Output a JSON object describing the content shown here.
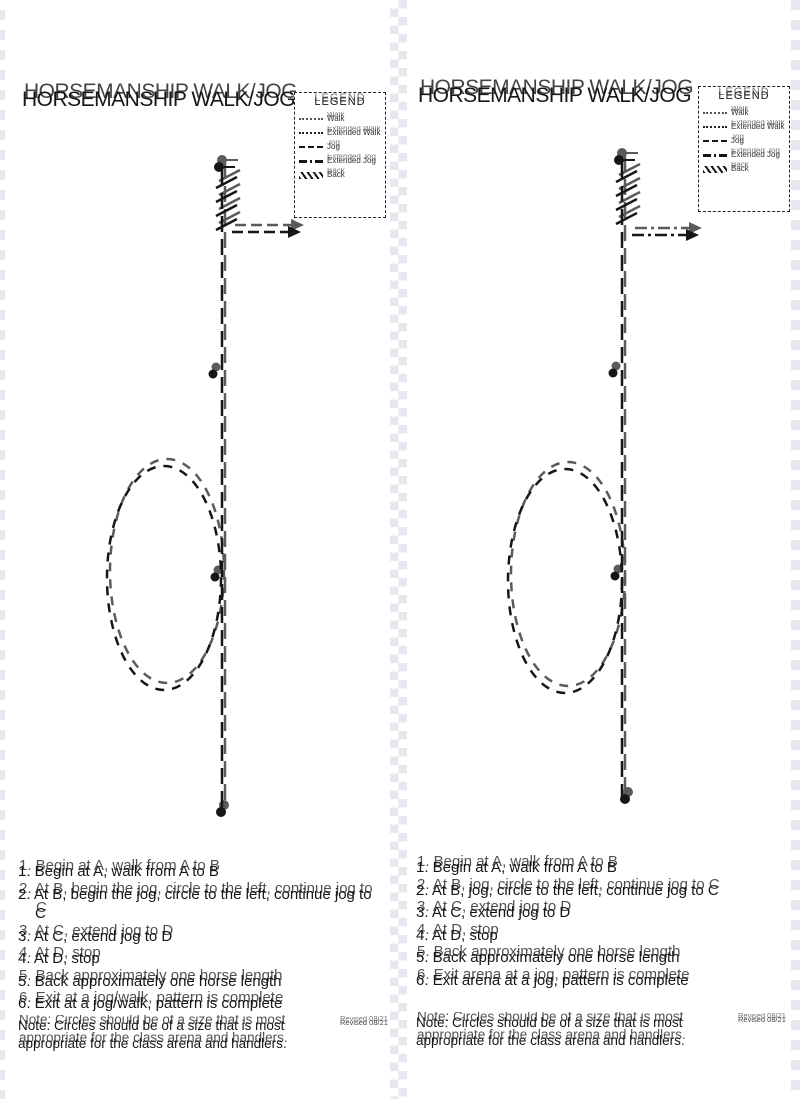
{
  "document": {
    "left_panel": {
      "title": "HORSEMANSHIP WALK/JOG",
      "legend": {
        "title": "LEGEND",
        "items": [
          {
            "label": "Walk",
            "symbol": "dotted-line"
          },
          {
            "label": "Extended Walk",
            "symbol": "dense-dotted-line"
          },
          {
            "label": "Jog",
            "symbol": "dashed-line"
          },
          {
            "label": "Extended Jog",
            "symbol": "dash-dot-line"
          },
          {
            "label": "Back",
            "symbol": "hatched-bar"
          }
        ]
      },
      "instructions": [
        "1. Begin at A, walk from A to B",
        "2. At B, begin the jog, circle to the left, continue jog to C",
        "3. At C, extend jog to D",
        "4. At D, stop",
        "5. Back approximately one horse length",
        "6. Exit at a jog/walk, pattern is complete"
      ],
      "note": "Note: Circles should be of a size that is most appropriate for the class arena and handlers.",
      "revised": "Revised 08/21"
    },
    "right_panel": {
      "title": "HORSEMANSHIP WALK/JOG",
      "legend": {
        "title": "LEGEND",
        "items": [
          {
            "label": "Walk",
            "symbol": "dotted-line"
          },
          {
            "label": "Extended Walk",
            "symbol": "dense-dotted-line"
          },
          {
            "label": "Jog",
            "symbol": "dashed-line"
          },
          {
            "label": "Extended Jog",
            "symbol": "dash-dot-line"
          },
          {
            "label": "Back",
            "symbol": "hatched-bar"
          }
        ]
      },
      "instructions": [
        "1. Begin at A, walk from A to B",
        "2. At B, jog, circle to the left, continue jog to C",
        "3. At C, extend jog to D",
        "4. At D, stop",
        "5. Back approximately one horse length",
        "6. Exit arena at a jog, pattern is complete"
      ],
      "note": "Note: Circles should be of a size that is most appropriate for the class arena and handlers.",
      "revised": "Revised 08/21"
    }
  }
}
